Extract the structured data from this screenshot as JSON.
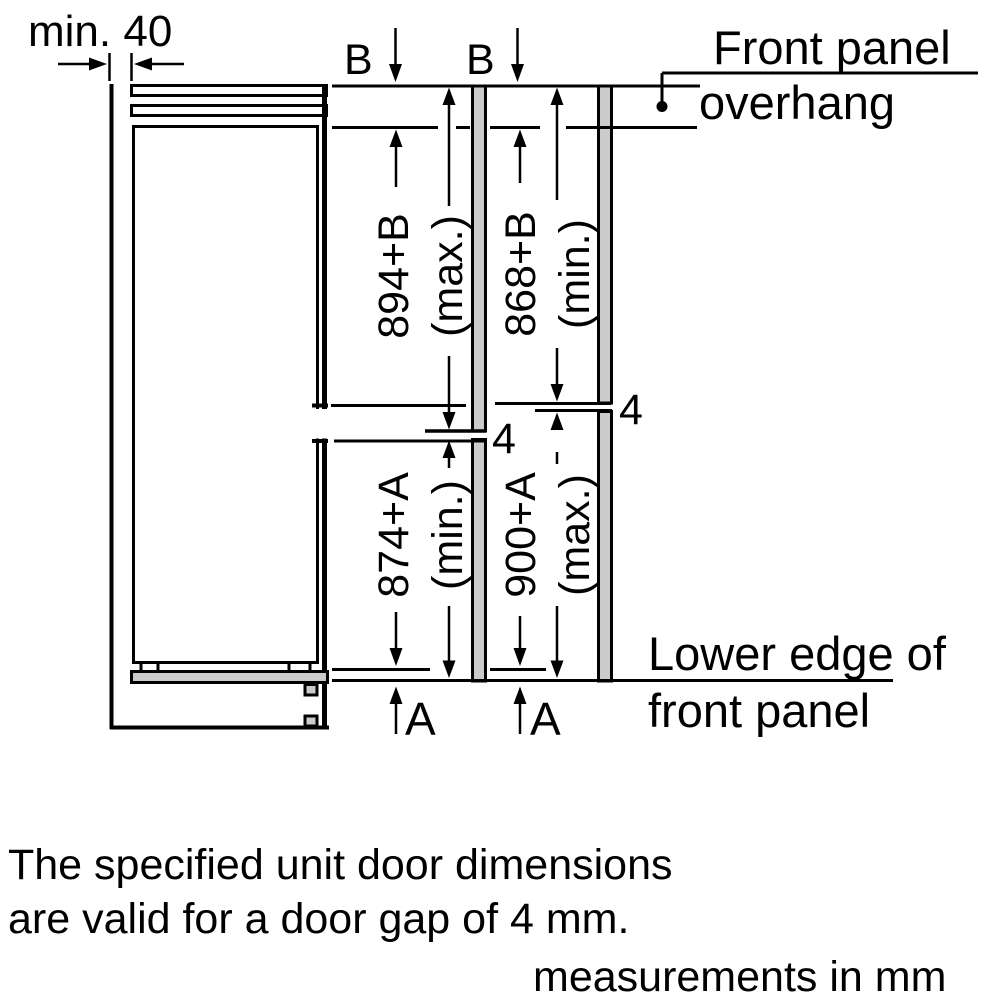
{
  "colors": {
    "line": "#000000",
    "panel_fill": "#cbcbcb",
    "background": "#ffffff"
  },
  "diagram": {
    "min_clearance_label": "min. 40",
    "b_labels": [
      "B",
      "B"
    ],
    "a_labels": [
      "A",
      "A"
    ],
    "gap_labels": {
      "left": "4",
      "right": "4"
    },
    "front_panel_overhang": {
      "line1": "Front panel",
      "line2": "overhang"
    },
    "lower_edge": {
      "line1": "Lower edge of",
      "line2": "front panel"
    },
    "dims": {
      "upper_left_value": "894+B",
      "upper_left_qual": "(max.)",
      "upper_right_value": "868+B",
      "upper_right_qual": "(min.)",
      "lower_left_value": "874+A",
      "lower_left_qual": "(min.)",
      "lower_right_value": "900+A",
      "lower_right_qual": "(max.)"
    }
  },
  "notes": {
    "line1": "The specified unit door dimensions",
    "line2": "are valid for a door gap of 4 mm.",
    "units": "measurements in mm"
  }
}
